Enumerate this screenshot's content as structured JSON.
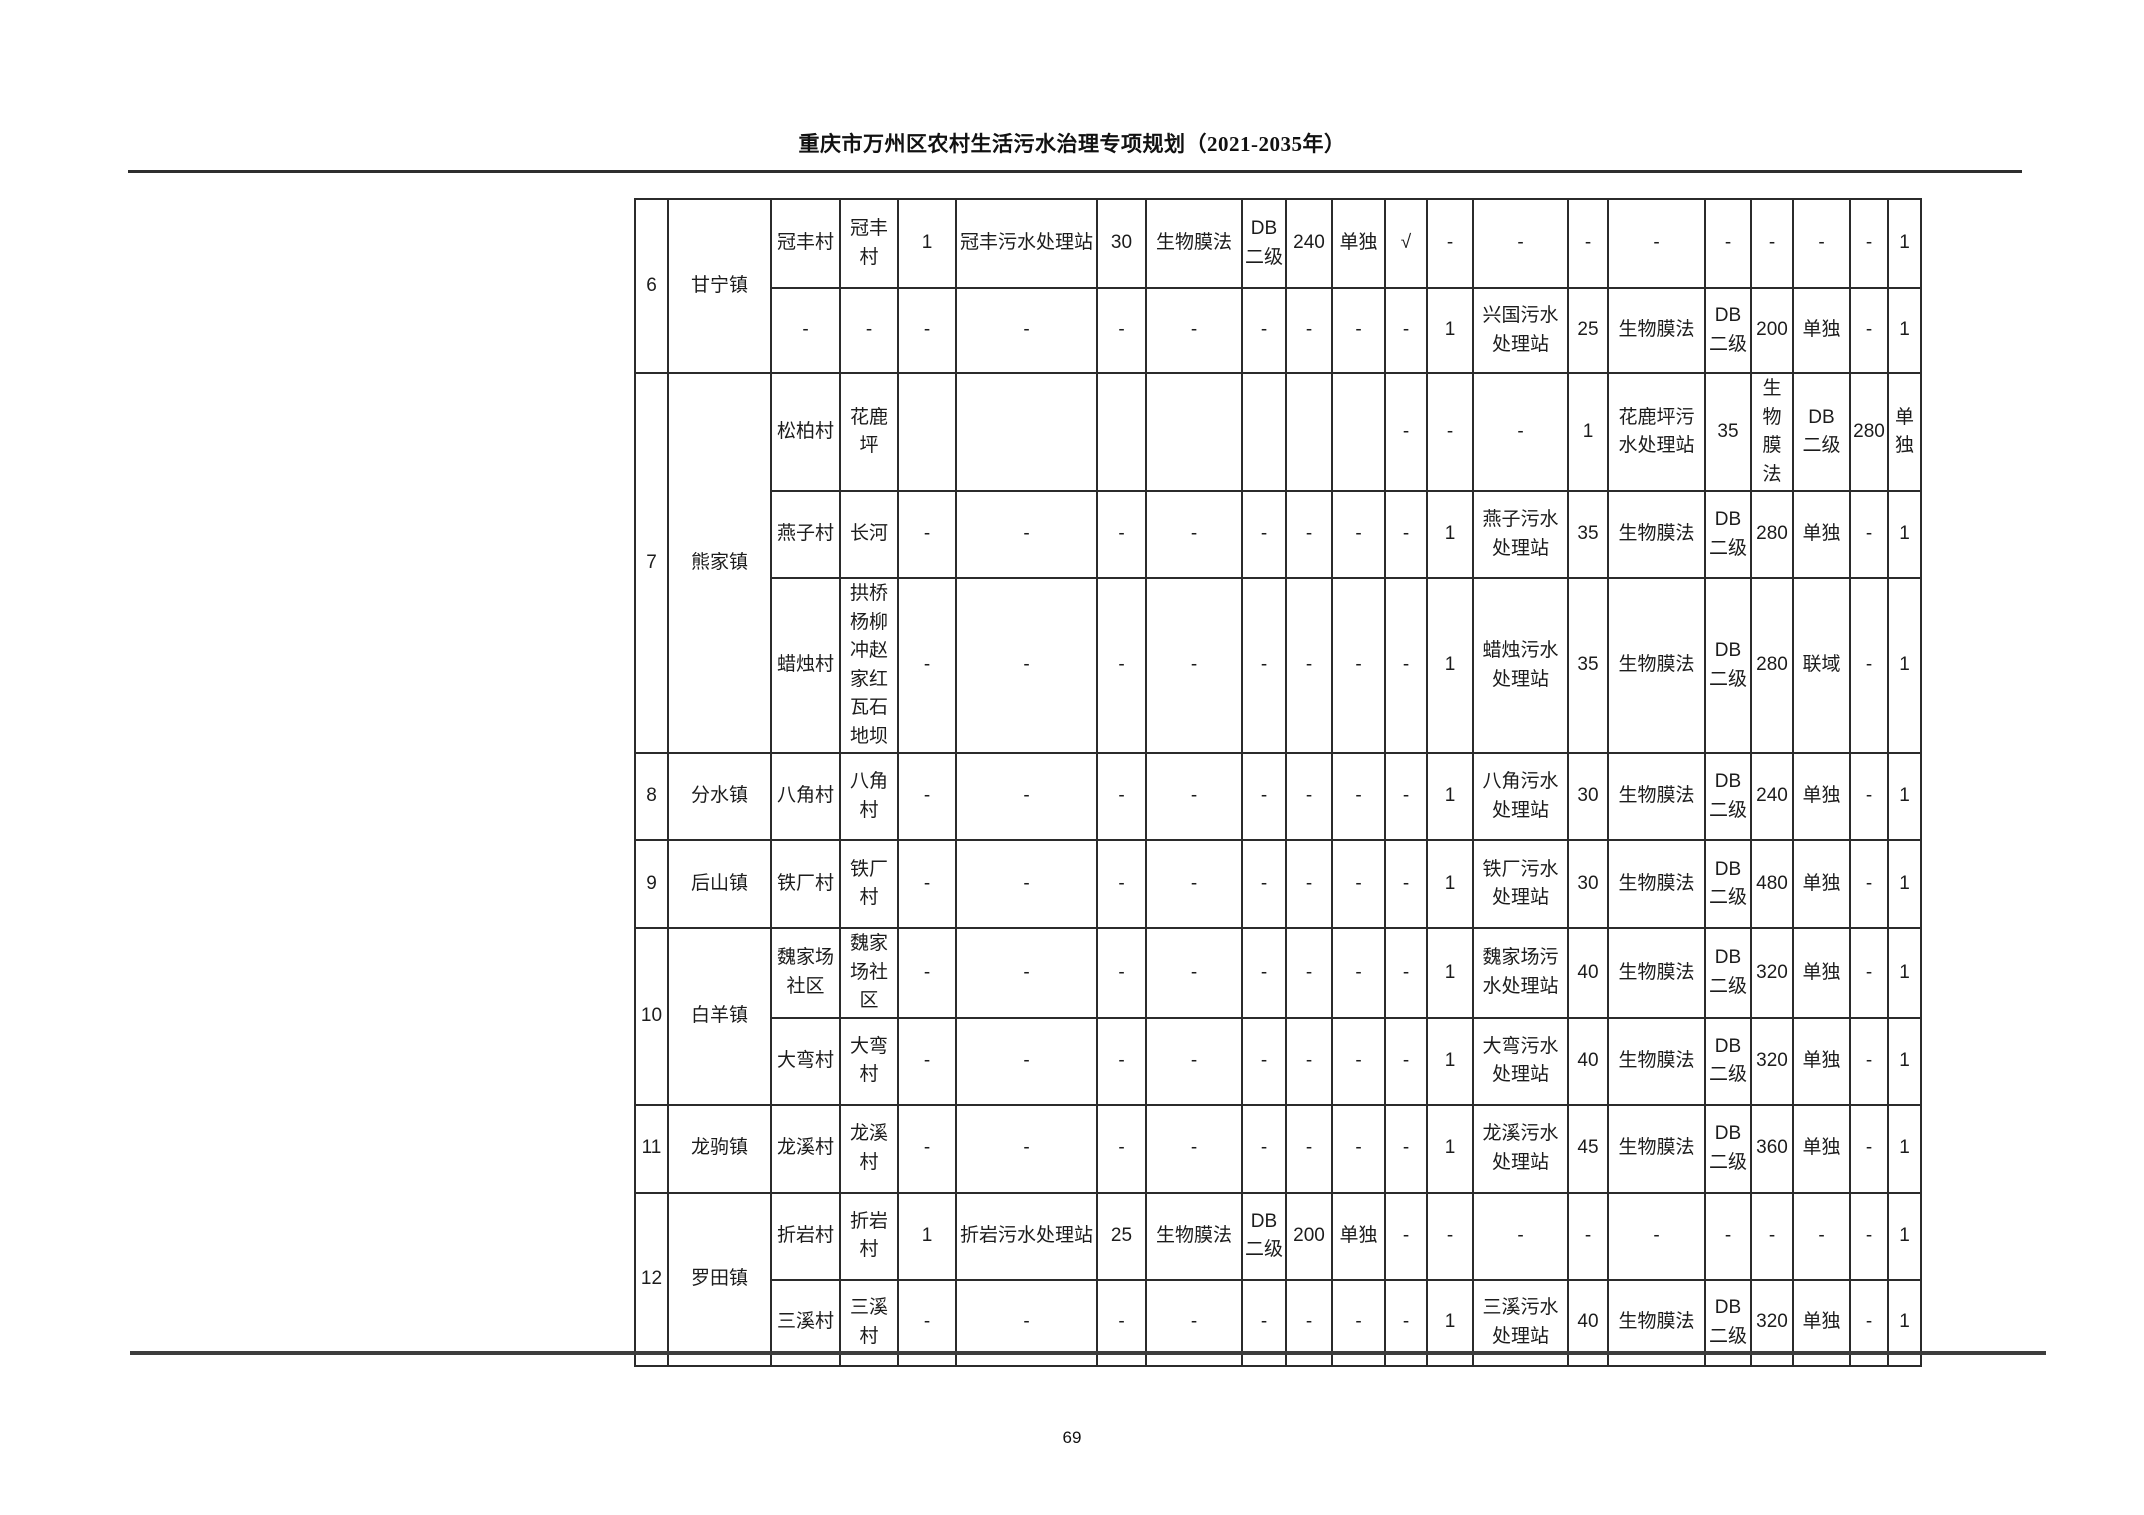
{
  "header": {
    "title": "重庆市万州区农村生活污水治理专项规划（2021-2035年）"
  },
  "footer": {
    "page_number": "69"
  },
  "table": {
    "col_widths": [
      33,
      103,
      69,
      58,
      58,
      141,
      49,
      96,
      44,
      46,
      53,
      42,
      46,
      95,
      40,
      97,
      46,
      42,
      57,
      38,
      33
    ],
    "row_heights": [
      89,
      85,
      87,
      87,
      172,
      87,
      88,
      87,
      87,
      88,
      87,
      86
    ],
    "groups": [
      {
        "no": "6",
        "town": "甘宁镇",
        "rows": [
          [
            "冠丰村",
            "冠丰村",
            "1",
            "冠丰污水处理站",
            "30",
            "生物膜法",
            "DB\n二级",
            "240",
            "单独",
            "√",
            "-",
            "-",
            "-",
            "-",
            "-",
            "-",
            "-",
            "-",
            "1"
          ],
          [
            "-",
            "-",
            "-",
            "-",
            "-",
            "-",
            "-",
            "-",
            "-",
            "-",
            "1",
            "兴国污水处理站",
            "25",
            "生物膜法",
            "DB\n二级",
            "200",
            "单独",
            "-",
            "1"
          ]
        ]
      },
      {
        "no": "7",
        "town": "熊家镇",
        "rows": [
          [
            "松柏村",
            "花鹿坪",
            "",
            "",
            "",
            "",
            "",
            "",
            "",
            "-",
            "-",
            "-",
            "1",
            "花鹿坪污水处理站",
            "35",
            "生物膜法",
            "DB\n二级",
            "280",
            "单独"
          ],
          [
            "燕子村",
            "长河",
            "-",
            "-",
            "-",
            "-",
            "-",
            "-",
            "-",
            "-",
            "1",
            "燕子污水处理站",
            "35",
            "生物膜法",
            "DB\n二级",
            "280",
            "单独",
            "-",
            "1"
          ],
          [
            "蜡烛村",
            "拱桥杨柳冲赵家红瓦石地坝",
            "-",
            "-",
            "-",
            "-",
            "-",
            "-",
            "-",
            "-",
            "1",
            "蜡烛污水处理站",
            "35",
            "生物膜法",
            "DB\n二级",
            "280",
            "联域",
            "-",
            "1"
          ]
        ]
      },
      {
        "no": "8",
        "town": "分水镇",
        "rows": [
          [
            "八角村",
            "八角村",
            "-",
            "-",
            "-",
            "-",
            "-",
            "-",
            "-",
            "-",
            "1",
            "八角污水处理站",
            "30",
            "生物膜法",
            "DB\n二级",
            "240",
            "单独",
            "-",
            "1"
          ]
        ]
      },
      {
        "no": "9",
        "town": "后山镇",
        "rows": [
          [
            "铁厂村",
            "铁厂村",
            "-",
            "-",
            "-",
            "-",
            "-",
            "-",
            "-",
            "-",
            "1",
            "铁厂污水处理站",
            "30",
            "生物膜法",
            "DB\n二级",
            "480",
            "单独",
            "-",
            "1"
          ]
        ]
      },
      {
        "no": "10",
        "town": "白羊镇",
        "rows": [
          [
            "魏家场社区",
            "魏家场社区",
            "-",
            "-",
            "-",
            "-",
            "-",
            "-",
            "-",
            "-",
            "1",
            "魏家场污水处理站",
            "40",
            "生物膜法",
            "DB\n二级",
            "320",
            "单独",
            "-",
            "1"
          ],
          [
            "大弯村",
            "大弯村",
            "-",
            "-",
            "-",
            "-",
            "-",
            "-",
            "-",
            "-",
            "1",
            "大弯污水处理站",
            "40",
            "生物膜法",
            "DB\n二级",
            "320",
            "单独",
            "-",
            "1"
          ]
        ]
      },
      {
        "no": "11",
        "town": "龙驹镇",
        "rows": [
          [
            "龙溪村",
            "龙溪村",
            "-",
            "-",
            "-",
            "-",
            "-",
            "-",
            "-",
            "-",
            "1",
            "龙溪污水处理站",
            "45",
            "生物膜法",
            "DB\n二级",
            "360",
            "单独",
            "-",
            "1"
          ]
        ]
      },
      {
        "no": "12",
        "town": "罗田镇",
        "rows": [
          [
            "折岩村",
            "折岩村",
            "1",
            "折岩污水处理站",
            "25",
            "生物膜法",
            "DB\n二级",
            "200",
            "单独",
            "-",
            "-",
            "-",
            "-",
            "-",
            "-",
            "-",
            "-",
            "-",
            "1"
          ],
          [
            "三溪村",
            "三溪村",
            "-",
            "-",
            "-",
            "-",
            "-",
            "-",
            "-",
            "-",
            "1",
            "三溪污水处理站",
            "40",
            "生物膜法",
            "DB\n二级",
            "320",
            "单独",
            "-",
            "1"
          ]
        ]
      }
    ],
    "row7a_trailing": [
      "-",
      "1"
    ]
  }
}
